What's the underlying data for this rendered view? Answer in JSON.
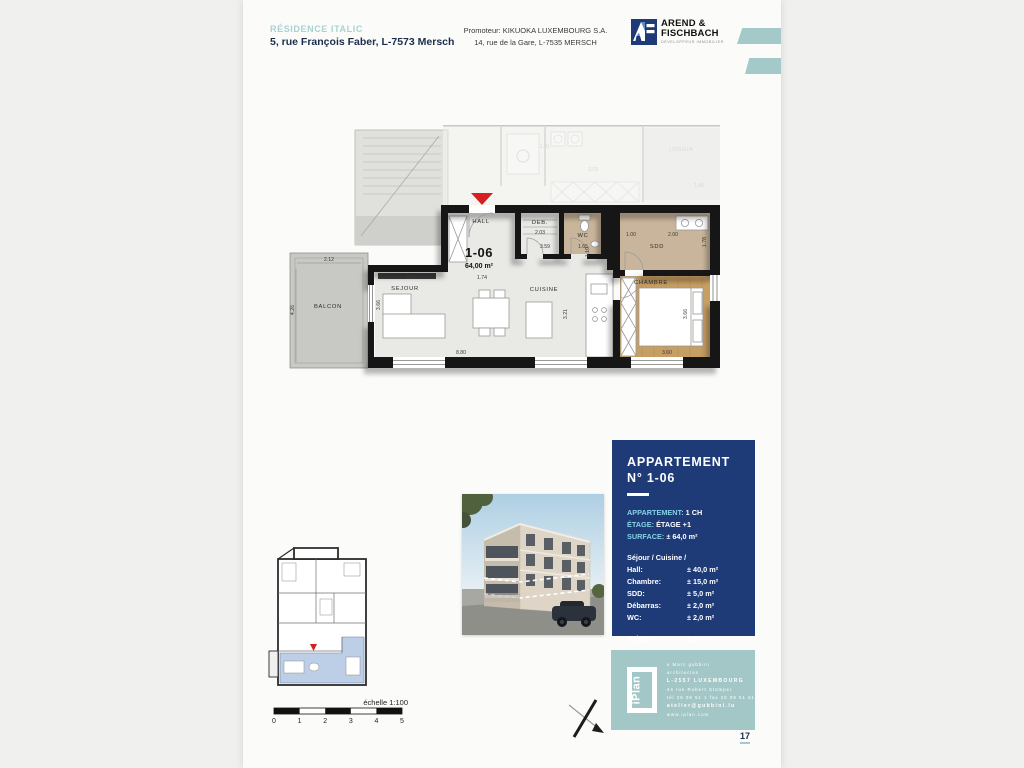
{
  "header": {
    "residence_name": "RÉSIDENCE ITALIC",
    "residence_address": "5, rue François Faber, L-7573 Mersch",
    "promoter_line1": "Promoteur: KIKUOKA LUXEMBOURG S.A.",
    "promoter_line2": "14, rue de la Gare, L-7535 MERSCH",
    "logo": {
      "name_line1": "AREND &",
      "name_line2": "FISCHBACH",
      "tagline": "DÉVELOPPEUR IMMOBILIER"
    }
  },
  "floor_plan": {
    "unit_number": "1-06",
    "unit_area": "64,00 m²",
    "rooms": {
      "hall": "HALL",
      "deb": "DEB.",
      "wc": "WC",
      "sdd": "SDD",
      "chambre": "CHAMBRE",
      "sejour": "SEJOUR",
      "cuisine": "CUISINE",
      "balcon": "BALCON",
      "loggia": "LOGGIA"
    },
    "dims": {
      "balcon_w": "2.12",
      "balcon_h": "4.26",
      "sejour_top": "3.47",
      "hall_top": "1.74",
      "sejour_left": "3.66",
      "bottom": "8.80",
      "cuisine_v": "3.21",
      "chambre_bottom": "3.60",
      "chambre_right": "3.66",
      "deb": "2.03",
      "wc": "1.65",
      "corridor": "3.59",
      "corridor_v": "1.10",
      "sdd_a": "1.00",
      "sdd_b": "2.00",
      "sdd_right": "1.78",
      "upper_a": "3.19",
      "upper_b": "1.80",
      "upper_c": "1.91"
    }
  },
  "info_panel": {
    "title_line1": "APPARTEMENT",
    "title_line2": "N° 1-06",
    "specs": [
      {
        "label": "APPARTEMENT:",
        "value": "1 CH"
      },
      {
        "label": "ÉTAGE:",
        "value": "ÉTAGE +1"
      },
      {
        "label": "SURFACE:",
        "value": "± 64,0 m²"
      }
    ],
    "rooms_heading": "Séjour / Cuisine /",
    "rooms": [
      {
        "label": "Hall:",
        "value": "± 40,0 m²"
      },
      {
        "label": "Chambre:",
        "value": "± 15,0 m²"
      },
      {
        "label": "SDD:",
        "value": "± 5,0 m²"
      },
      {
        "label": "Débarras:",
        "value": "± 2,0 m²"
      },
      {
        "label": "WC:",
        "value": "± 2,0 m²"
      }
    ],
    "balcony": {
      "label": "Balcon:",
      "value": "± 9,0 m²"
    }
  },
  "iplan": {
    "logo_text": "iPlan",
    "lines": [
      "e Marc gubbini",
      "architectes",
      "L-2557 LUXEMBOURG",
      "44 rue Robert Stümper",
      "tél 26 09 51 1  fax 26 09 51 51",
      "atelier@gubbini.lu",
      "www.iplan.com"
    ]
  },
  "scale_bar": {
    "label": "échelle 1:100",
    "ticks": [
      "0",
      "1",
      "2",
      "3",
      "4",
      "5"
    ]
  },
  "page_number": "17",
  "colors": {
    "navy_panel": "#1e3b78",
    "teal_accent": "#a3c9c9",
    "label_blue": "#86d0e6",
    "entrance_red": "#d42020",
    "wood_floor": "#c79e63",
    "tile_floor": "#c9b59b"
  }
}
